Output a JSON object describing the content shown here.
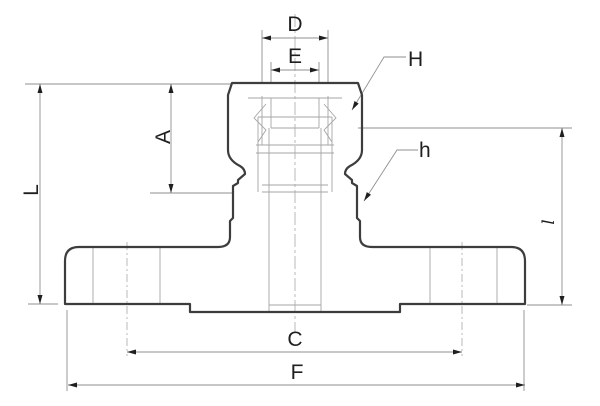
{
  "drawing": {
    "description": "Technical cross-section drawing of a flanged compression tube fitting with dimension callouts",
    "labels": {
      "D": "D",
      "E": "E",
      "H": "H",
      "h": "h",
      "A": "A",
      "L": "L",
      "l": "l",
      "C": "C",
      "F": "F"
    },
    "colors": {
      "background": "#ffffff",
      "outline": "#3d3d3d",
      "detail": "#a6a6a6",
      "dimension": "#8f8f8f",
      "centerline": "#b2b2b2",
      "annotation": "#1f1f1f"
    }
  }
}
